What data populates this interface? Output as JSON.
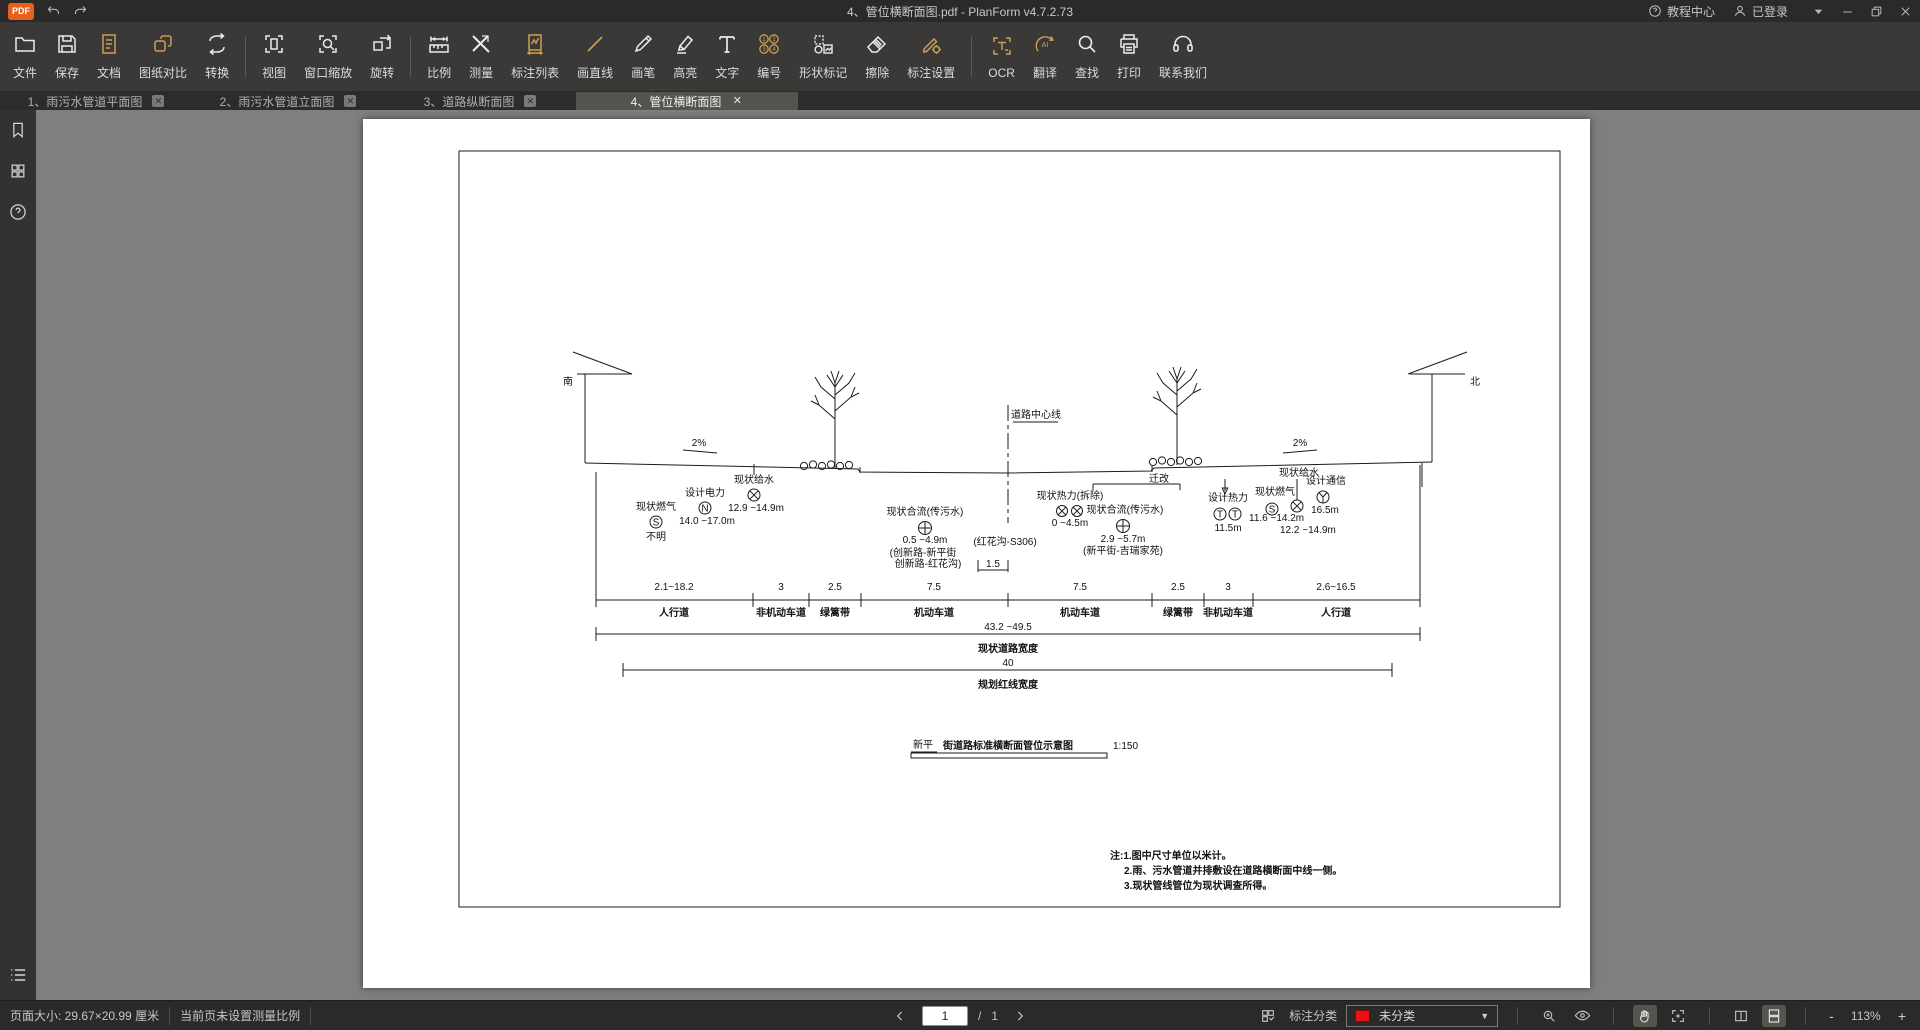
{
  "titlebar": {
    "logo_text": "PDF",
    "app_title": "4、管位横断面图.pdf - PlanForm v4.7.2.73",
    "tutorial_label": "教程中心",
    "login_label": "已登录"
  },
  "toolbar": {
    "items": [
      {
        "label": "文件",
        "icon": "folder-icon",
        "accent": false
      },
      {
        "label": "保存",
        "icon": "save-icon",
        "accent": false
      },
      {
        "label": "文档",
        "icon": "document-icon",
        "accent": true
      },
      {
        "label": "图纸对比",
        "icon": "compare-icon",
        "accent": true
      },
      {
        "label": "转换",
        "icon": "convert-icon",
        "accent": false
      },
      {
        "label": "视图",
        "icon": "view-icon",
        "accent": false
      },
      {
        "label": "窗口缩放",
        "icon": "window-zoom-icon",
        "accent": false
      },
      {
        "label": "旋转",
        "icon": "rotate-icon",
        "accent": false
      },
      {
        "label": "比例",
        "icon": "scale-icon",
        "accent": false
      },
      {
        "label": "测量",
        "icon": "measure-icon",
        "accent": false
      },
      {
        "label": "标注列表",
        "icon": "annotation-list-icon",
        "accent": true
      },
      {
        "label": "画直线",
        "icon": "line-icon",
        "accent": true
      },
      {
        "label": "画笔",
        "icon": "pen-icon",
        "accent": false
      },
      {
        "label": "高亮",
        "icon": "highlight-icon",
        "accent": false
      },
      {
        "label": "文字",
        "icon": "text-icon",
        "accent": false
      },
      {
        "label": "编号",
        "icon": "number-icon",
        "accent": true
      },
      {
        "label": "形状标记",
        "icon": "shape-mark-icon",
        "accent": false
      },
      {
        "label": "擦除",
        "icon": "erase-icon",
        "accent": false
      },
      {
        "label": "标注设置",
        "icon": "annotation-settings-icon",
        "accent": true
      },
      {
        "label": "OCR",
        "icon": "ocr-icon",
        "accent": true
      },
      {
        "label": "翻译",
        "icon": "translate-icon",
        "accent": true
      },
      {
        "label": "查找",
        "icon": "find-icon",
        "accent": false
      },
      {
        "label": "打印",
        "icon": "print-icon",
        "accent": false
      },
      {
        "label": "联系我们",
        "icon": "contact-icon",
        "accent": false
      }
    ]
  },
  "tabs": [
    {
      "label": "1、雨污水管道平面图"
    },
    {
      "label": "2、雨污水管道立面图"
    },
    {
      "label": "3、道路纵断面图"
    },
    {
      "label": "4、管位横断面图"
    }
  ],
  "statusbar": {
    "page_size": "页面大小: 29.67×20.99 厘米",
    "scale_hint": "当前页未设置测量比例",
    "page_current": "1",
    "page_divider": "/",
    "page_total": "1",
    "annotation_class_label": "标注分类",
    "class_value": "未分类",
    "zoom_out": "-",
    "zoom_level": "113%",
    "zoom_in": "+"
  },
  "drawing": {
    "direction_left": "南",
    "direction_right": "北",
    "slope_left": "2%",
    "slope_right": "2%",
    "centerline_label": "道路中心线",
    "relocate_label": "迁改",
    "utilities": {
      "gas_existing_left": {
        "name": "现状燃气",
        "symbol": "S",
        "depth": "不明"
      },
      "power_design": {
        "name": "设计电力",
        "symbol": "N",
        "depth": "14.0 ~17.0m"
      },
      "water_existing_left": {
        "name": "现状给水",
        "depth": "12.9 ~14.9m"
      },
      "combined_sewer_center": {
        "name": "现状合流(传污水)",
        "depth": "0.5 ~4.9m",
        "range_note": "(红花沟-S306)",
        "section_note1": "(创新路-新平街",
        "section_note2": "创新路-红花沟)",
        "offset_dim": "1.5"
      },
      "heat_demolish": {
        "name": "现状热力(拆除)",
        "depth": "0 ~4.5m"
      },
      "combined_sewer_right": {
        "name": "现状合流(传污水)",
        "depth": "2.9 ~5.7m",
        "section_note": "(新平街-吉瑞家苑)"
      },
      "heat_design": {
        "name": "设计热力",
        "symbol": "T",
        "depth": "11.5m"
      },
      "gas_existing_right": {
        "name": "现状燃气",
        "symbol": "S",
        "depth": "11.6 ~14.2m"
      },
      "water_existing_right": {
        "name": "现状给水",
        "depth": "12.2 ~14.9m"
      },
      "telecom_design": {
        "name": "设计通信",
        "depth": "16.5m"
      }
    },
    "dimensions": {
      "segments": [
        {
          "value": "2.1~18.2",
          "label": "人行道"
        },
        {
          "value": "3",
          "label": "非机动车道"
        },
        {
          "value": "2.5",
          "label": "绿篱带"
        },
        {
          "value": "7.5",
          "label": "机动车道"
        },
        {
          "value": "7.5",
          "label": "机动车道"
        },
        {
          "value": "2.5",
          "label": "绿篱带"
        },
        {
          "value": "3",
          "label": "非机动车道"
        },
        {
          "value": "2.6~16.5",
          "label": "人行道"
        }
      ],
      "total_existing": {
        "value": "43.2 ~49.5",
        "label": "现状道路宽度"
      },
      "total_planned": {
        "value": "40",
        "label": "规划红线宽度"
      }
    },
    "title": {
      "street": "新平",
      "rest": "街道路标准横断面管位示意图",
      "scale": "1:150"
    },
    "notes": {
      "line1": "注:1.图中尺寸单位以米计。",
      "line2": "2.雨、污水管道并排敷设在道路横断面中线一侧。",
      "line3": "3.现状管线管位为现状调查所得。"
    }
  }
}
